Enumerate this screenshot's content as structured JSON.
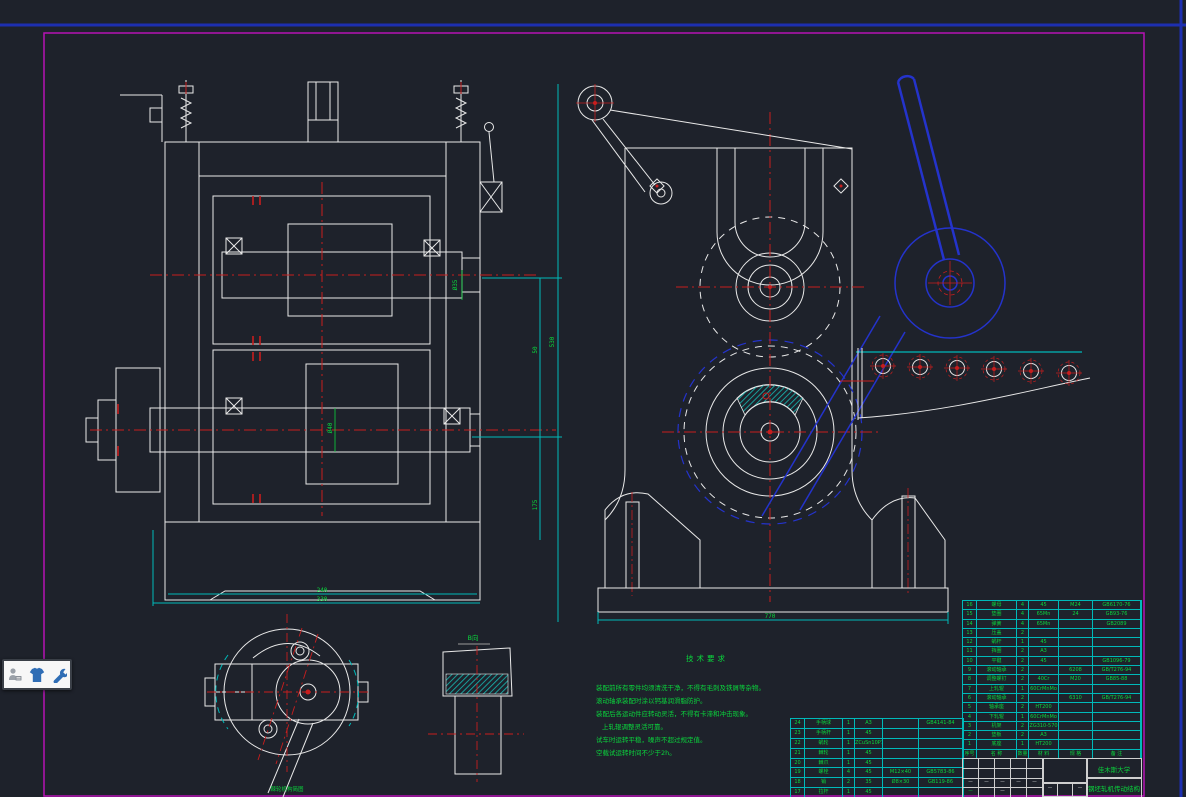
{
  "app": {
    "background": "#1e222b",
    "border_magenta": "#b513b5",
    "page_edge_blue": "#1d2fb0",
    "line_white": "#e9e9e9",
    "hatch_cyan": "#00b9b9",
    "centerline_red": "#c81e1e",
    "overlay_blue": "#2433cc",
    "text_green": "#0ad53c"
  },
  "toolbar": {
    "icons": [
      {
        "name": "reader-icon"
      },
      {
        "name": "shirt-icon"
      },
      {
        "name": "wrench-icon"
      }
    ]
  },
  "dimensions": {
    "d240": "240",
    "d330": "330",
    "d770": "770",
    "d50": "50",
    "d175": "175",
    "d530": "530",
    "dia40": "Ø40",
    "dia35": "Ø35"
  },
  "labels": {
    "view_b": "B向",
    "detail_caption": "棘轮机构简图"
  },
  "tech_requirements": {
    "title": "技术要求",
    "lines": [
      "装配前所有零件均须清洗干净，不得有毛刺及铁屑等杂物。",
      "滚动轴承装配时涂以钙基润滑脂防护。",
      "装配后各运动件应转动灵活，不得有卡滞和冲击现象。",
      "上轧辊调整灵活可靠。",
      "试车时运转平稳，噪声不超过规定值。",
      "空载试运转时间不少于2h。"
    ]
  },
  "title_block": {
    "org": "佳木斯大学",
    "drawing": "钢坯轧机传动结构",
    "marks": [
      "—",
      "",
      "—"
    ]
  },
  "bom_right": {
    "row_h": 9.3,
    "widths": [
      14,
      40,
      12,
      30,
      34,
      48
    ],
    "rows": [
      [
        "16",
        "螺母",
        "4",
        "45",
        "M24",
        "GB6170-76"
      ],
      [
        "15",
        "垫圈",
        "4",
        "65Mn",
        "24",
        "GB93-76"
      ],
      [
        "14",
        "弹簧",
        "4",
        "65Mn",
        "",
        "GB2089"
      ],
      [
        "13",
        "压盖",
        "2",
        "",
        "",
        ""
      ],
      [
        "12",
        "蜗杆",
        "1",
        "45",
        "",
        ""
      ],
      [
        "11",
        "挡圈",
        "2",
        "A3",
        "",
        ""
      ],
      [
        "10",
        "平键",
        "2",
        "45",
        "",
        "GB1096-79"
      ],
      [
        "9",
        "滚动轴承",
        "2",
        "",
        "6208",
        "GB/T276-94"
      ],
      [
        "8",
        "调整螺钉",
        "2",
        "40Cr",
        "M20",
        "GB85-88"
      ],
      [
        "7",
        "上轧辊",
        "1",
        "60CrMnMo",
        "",
        ""
      ],
      [
        "6",
        "滚动轴承",
        "2",
        "",
        "6310",
        "GB/T276-94"
      ],
      [
        "5",
        "轴承座",
        "2",
        "HT200",
        "",
        ""
      ],
      [
        "4",
        "下轧辊",
        "1",
        "60CrMnMo",
        "",
        ""
      ],
      [
        "3",
        "机架",
        "2",
        "ZG310-570",
        "",
        ""
      ],
      [
        "2",
        "垫板",
        "2",
        "A3",
        "",
        ""
      ],
      [
        "1",
        "底座",
        "1",
        "HT200",
        "",
        ""
      ],
      [
        "序号",
        "名 称",
        "数量",
        "材 料",
        "规 格",
        "备 注"
      ]
    ]
  },
  "bom_left": {
    "row_h": 9.875,
    "widths": [
      14,
      38,
      12,
      28,
      36,
      44
    ],
    "rows": [
      [
        "24",
        "手柄球",
        "1",
        "A3",
        "",
        "GB4141-84"
      ],
      [
        "23",
        "手柄杆",
        "1",
        "45",
        "",
        ""
      ],
      [
        "22",
        "蜗轮",
        "1",
        "ZCuSn10P1",
        "",
        ""
      ],
      [
        "21",
        "棘轮",
        "1",
        "45",
        "",
        ""
      ],
      [
        "20",
        "棘爪",
        "1",
        "45",
        "",
        ""
      ],
      [
        "19",
        "螺栓",
        "4",
        "45",
        "M12×40",
        "GB5783-86"
      ],
      [
        "18",
        "销",
        "2",
        "35",
        "Ø8×30",
        "GB119-86"
      ],
      [
        "17",
        "拉杆",
        "1",
        "45",
        "",
        ""
      ]
    ]
  },
  "sig_grid": {
    "row_h": 9.75,
    "widths": [
      16,
      16,
      16,
      16,
      16
    ],
    "rows": [
      [
        "",
        "",
        "",
        "",
        ""
      ],
      [
        "",
        "",
        "",
        "",
        ""
      ],
      [
        "—",
        "—",
        "—",
        "—",
        "—"
      ],
      [
        "g|—",
        "",
        "—",
        "",
        ""
      ]
    ]
  }
}
